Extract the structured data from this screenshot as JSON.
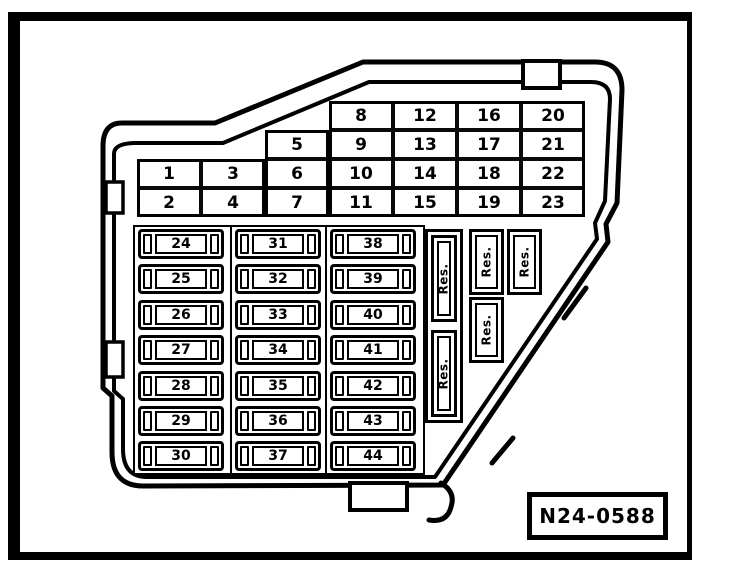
{
  "diagram": {
    "title": "fuse-and-relay-panel-diagram",
    "part_number": "N24-0588",
    "upper_grid": {
      "columns": [
        {
          "cells": [
            "1",
            "2"
          ]
        },
        {
          "cells": [
            "3",
            "4"
          ]
        },
        {
          "cells": [
            "5",
            "6",
            "7"
          ]
        },
        {
          "cells": [
            "8",
            "9",
            "10",
            "11"
          ]
        },
        {
          "cells": [
            "12",
            "13",
            "14",
            "15"
          ]
        },
        {
          "cells": [
            "16",
            "17",
            "18",
            "19"
          ]
        },
        {
          "cells": [
            "20",
            "21",
            "22",
            "23"
          ]
        }
      ]
    },
    "fuse_columns": [
      [
        "24",
        "25",
        "26",
        "27",
        "28",
        "29",
        "30"
      ],
      [
        "31",
        "32",
        "33",
        "34",
        "35",
        "36",
        "37"
      ],
      [
        "38",
        "39",
        "40",
        "41",
        "42",
        "43",
        "44"
      ]
    ],
    "reserve_groups": [
      {
        "slots": [
          "Res.",
          "Res."
        ]
      },
      {
        "slots": [
          "Res.",
          "Res."
        ]
      },
      {
        "slots": [
          "Res."
        ]
      }
    ],
    "colors": {
      "ink": "#000000",
      "paper": "#ffffff"
    }
  }
}
